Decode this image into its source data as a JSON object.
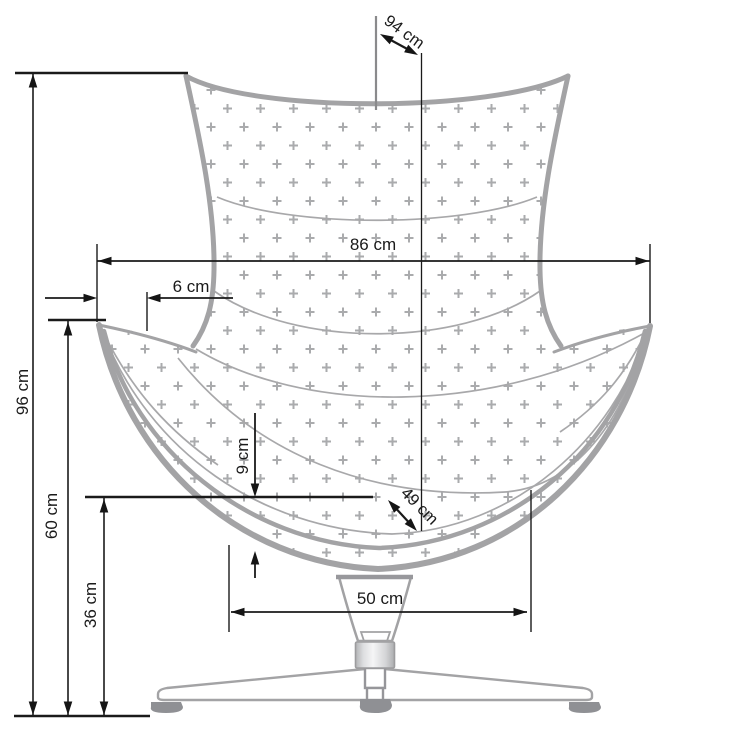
{
  "figure": {
    "subject": "Swivel egg chair — front view dimensional drawing",
    "unit": "cm",
    "measurements": [
      {
        "id": "top-diagonal",
        "label": "94 cm",
        "value": 94
      },
      {
        "id": "overall-width",
        "label": "86 cm",
        "value": 86
      },
      {
        "id": "wing-offset",
        "label": "6 cm",
        "value": 6
      },
      {
        "id": "overall-height",
        "label": "96 cm",
        "value": 96
      },
      {
        "id": "cushion-depth",
        "label": "9 cm",
        "value": 9
      },
      {
        "id": "seat-diagonal",
        "label": "49 cm",
        "value": 49
      },
      {
        "id": "seat-height",
        "label": "60 cm",
        "value": 60
      },
      {
        "id": "base-height",
        "label": "36 cm",
        "value": 36
      },
      {
        "id": "base-width",
        "label": "50 cm",
        "value": 50
      }
    ],
    "colors": {
      "dimension_line": "#1a1a1a",
      "shell_outline": "#a3a3a5",
      "upholstery_pattern": "#aaabad",
      "foot_pads": "#8f9094"
    }
  }
}
